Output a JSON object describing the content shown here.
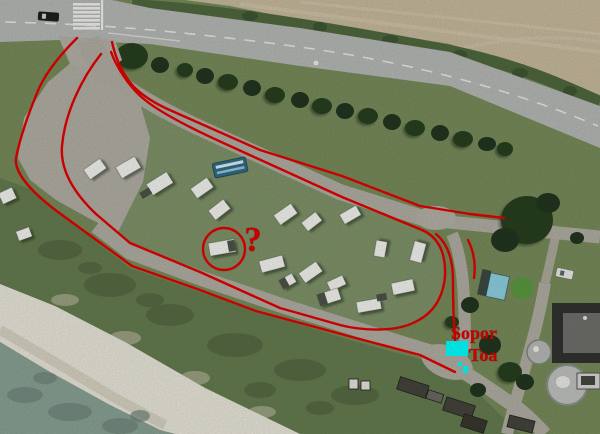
{
  "annotations": {
    "outline_color": "#e60000",
    "marker_color": "#00ffff",
    "question_mark": "?",
    "labels": {
      "sopor": "Sopor",
      "toa": "Toa"
    }
  }
}
